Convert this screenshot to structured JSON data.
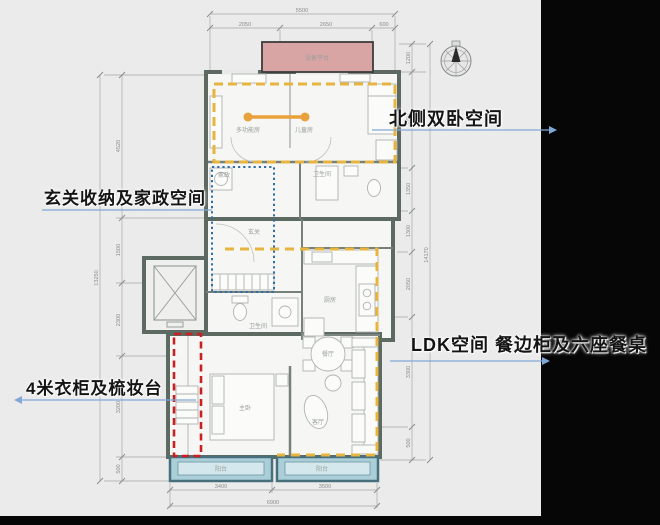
{
  "annotations": {
    "north_bedrooms": "北侧双卧空间",
    "entry_storage": "玄关收纳及家政空间",
    "wardrobe": "4米衣柜及梳妆台",
    "ldk": "LDK空间 餐边柜及六座餐桌"
  },
  "rooms": {
    "equipment_platform": "设备平台",
    "multi_function": "多功能房",
    "kids": "儿童房",
    "housekeeping": "家政",
    "bath_north": "卫生间",
    "entry": "玄关",
    "bath_master": "卫生间",
    "kitchen": "厨房",
    "dining": "餐厅",
    "living": "客厅",
    "master": "主卧",
    "balcony_left": "阳台",
    "balcony_right": "阳台"
  },
  "dimensions": {
    "top": {
      "overall": "5500",
      "segments": [
        "2050",
        "2650",
        "600"
      ]
    },
    "left": {
      "overall": "13250",
      "segments": [
        "4520",
        "1500",
        "2300",
        "3200",
        "500"
      ]
    },
    "right": {
      "overall": "14170",
      "segments": [
        "1200",
        "3050",
        "1350",
        "1300",
        "2050",
        "3300",
        "500"
      ]
    },
    "bottom": {
      "overall": "6900",
      "segments": [
        "3400",
        "3500"
      ]
    }
  },
  "colors": {
    "background": "#ebebeb",
    "panel_black": "#060606",
    "wall": "#5c6a62",
    "accent_yellow": "#e7b440",
    "accent_orange": "#e9a23b",
    "accent_blue_dotted": "#2e6da8",
    "accent_red": "#c92121",
    "balcony_teal": "#aacfd9",
    "platform_pink": "#d9a4a4",
    "arrow_blue": "#7fa8d8"
  }
}
